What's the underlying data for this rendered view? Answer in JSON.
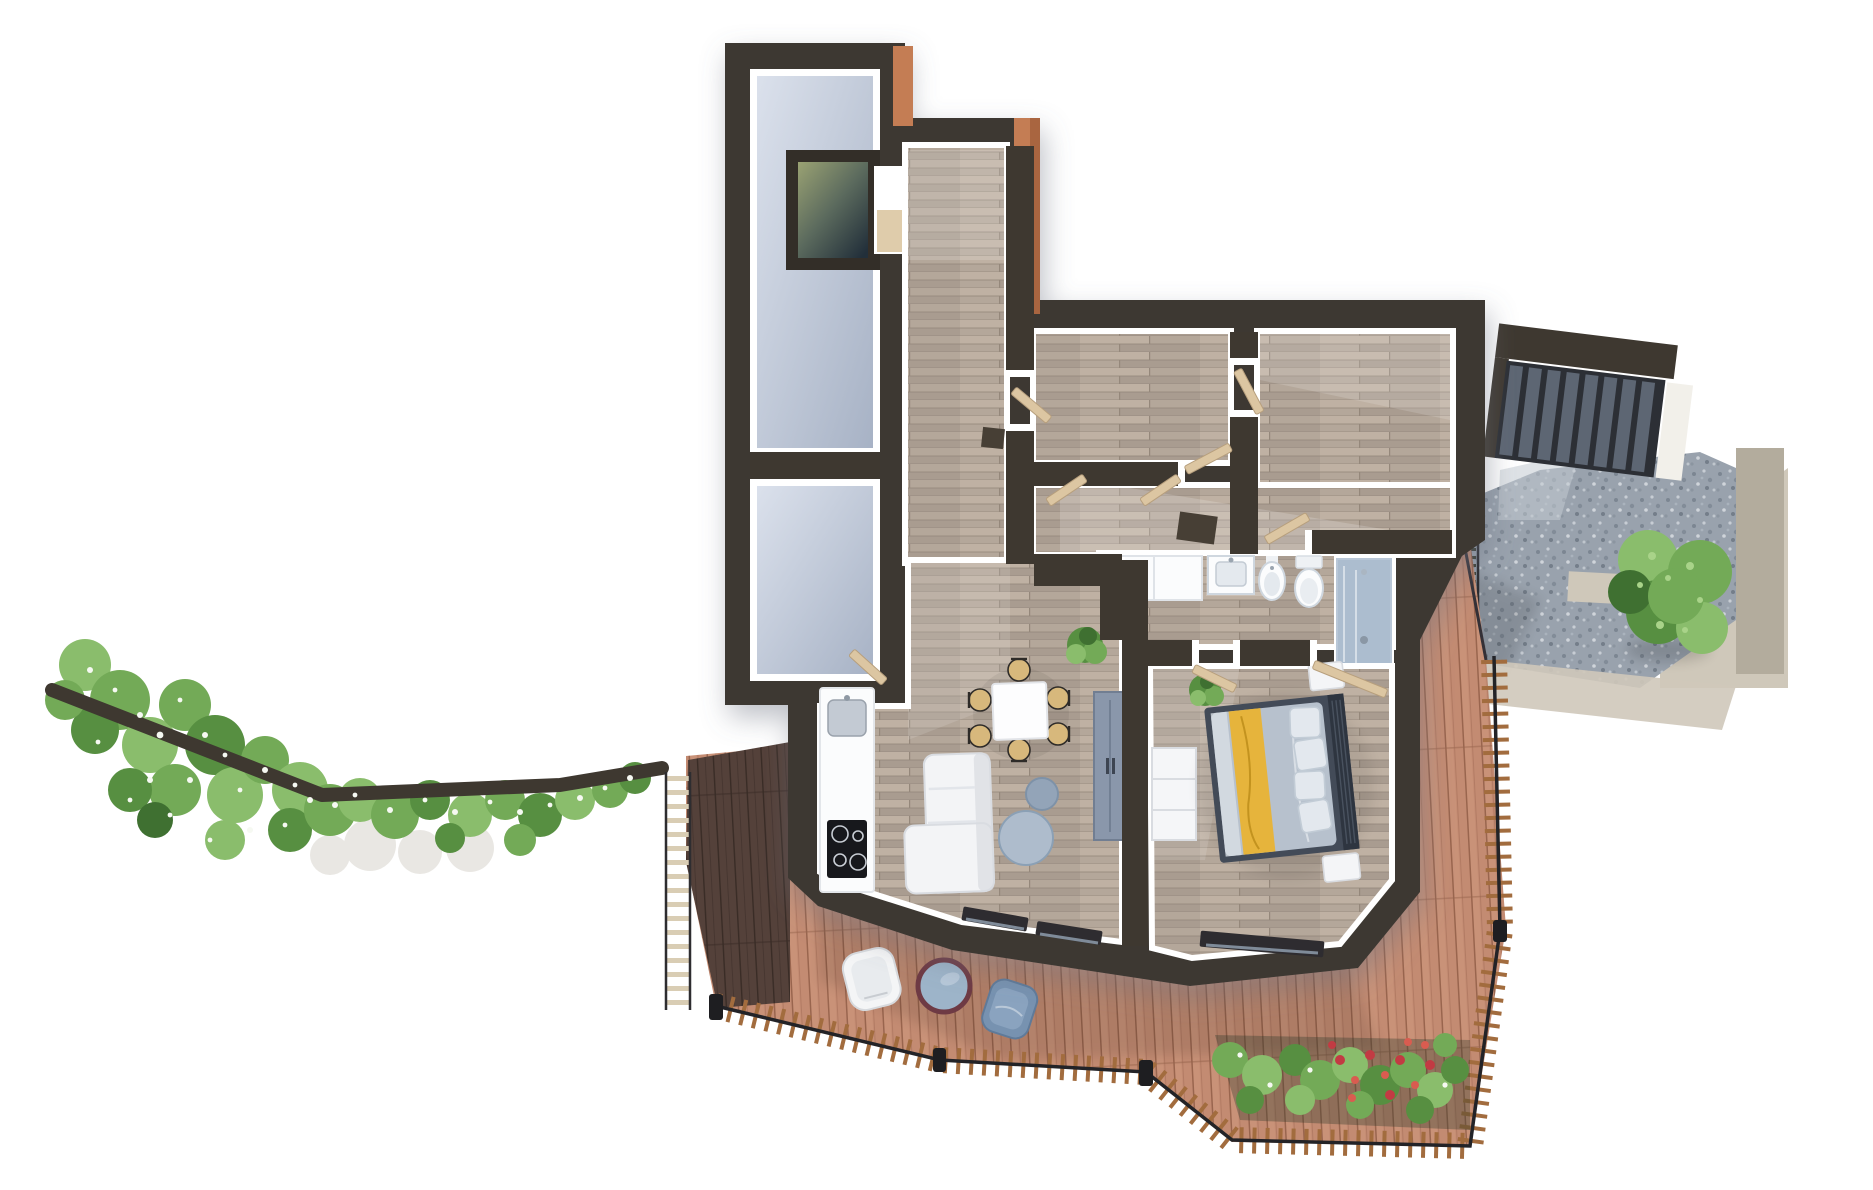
{
  "meta": {
    "type": "3d-floorplan-render",
    "view": "top-down-isometric",
    "text_visible": false
  },
  "colors": {
    "wall": "#3e3830",
    "wallEdge": "#2c2721",
    "copper": "#c47d54",
    "copperD": "#a96540",
    "conc1": "#dbe1ec",
    "conc2": "#a7b2c5",
    "wood": "#b4a79a",
    "woodGap": "#95887b",
    "woodL": "#c9bcac",
    "woodD": "#a29588",
    "deck": "#c38b72",
    "deckGap": "#99654e",
    "deckL": "#d8a489",
    "deckD": "#54413a",
    "deckDGap": "#392c26",
    "railWood": "#a26c3e",
    "rail": "#232327",
    "slat": "#d9cdb4",
    "gravel": "#99a2ad",
    "stone": "#cfc8ba",
    "stoneD": "#b3ac9d",
    "stair": "#5d6673",
    "stairD": "#2c2f35",
    "door": "#dcc6a2",
    "doorEdge": "#b79f7d",
    "white": "#ffffff",
    "offwhite": "#eef0f3",
    "sofa": "#f3f4f6",
    "sofaD": "#d9dce1",
    "tblBlue": "#aebccc",
    "tblBlue2": "#93a4b8",
    "chairTan": "#d7b87c",
    "chairFrame": "#2e2b28",
    "cooktop": "#17181c",
    "steel": "#c3cad3",
    "shower": "#8aa2bd",
    "fixture": "#fbfcfd",
    "fixEdge": "#cfd7df",
    "basin": "#e4e9ee",
    "wardrobe": "#8a97ab",
    "glass": "#9db4c9",
    "tableRim": "#6e3a44",
    "blueChair": "#7792b0",
    "blueChairL": "#8aa3bf",
    "bedFrame": "#434b58",
    "bedHead": "#2e3540",
    "duvet": "#b7c1cd",
    "duvetL": "#d8dee5",
    "yellow": "#e6b43c",
    "yellowD": "#c3931f",
    "pillow": "#e3e8ee",
    "g0": "#3f7031",
    "g1": "#73aa57",
    "g2": "#8abd6c",
    "g3": "#578f41",
    "g4": "#a9d389",
    "r1": "#c23b43",
    "r2": "#d95c50",
    "fw": "#f6f9f2",
    "path": "#e7e5e0",
    "soil": "#2f3a2c"
  },
  "scene": {
    "rooms": [
      "stairwell-with-skylight",
      "storage-room",
      "corridor",
      "room-a",
      "room-b",
      "hallway",
      "bathroom",
      "shower-room",
      "living-dining-kitchen",
      "bedroom"
    ],
    "furniture": [
      "kitchen-counter",
      "sink",
      "cooktop",
      "dining-table",
      "dining-chairs",
      "sofa",
      "coffee-tables",
      "wardrobe",
      "dresser",
      "vanity",
      "washbasin",
      "bidet",
      "toilet",
      "shower",
      "double-bed",
      "nightstands",
      "plants"
    ],
    "exterior": [
      "terrace-deck",
      "deck-railing",
      "pergola-slats",
      "outdoor-chair-white",
      "outdoor-table-round",
      "outdoor-chair-blue",
      "flower-bed",
      "hedge-with-flowers",
      "gravel-courtyard",
      "retaining-walls",
      "exterior-stairs",
      "tree"
    ]
  },
  "scatter": {
    "hedge": [
      [
        85,
        665,
        26,
        "g2"
      ],
      [
        120,
        700,
        30,
        "g1"
      ],
      [
        95,
        730,
        24,
        "g3"
      ],
      [
        150,
        745,
        28,
        "g2"
      ],
      [
        185,
        705,
        26,
        "g1"
      ],
      [
        215,
        745,
        30,
        "g3"
      ],
      [
        175,
        790,
        26,
        "g1"
      ],
      [
        235,
        795,
        28,
        "g2"
      ],
      [
        130,
        790,
        22,
        "g3"
      ],
      [
        265,
        760,
        24,
        "g1"
      ],
      [
        300,
        790,
        28,
        "g2"
      ],
      [
        290,
        830,
        22,
        "g3"
      ],
      [
        330,
        810,
        26,
        "g1"
      ],
      [
        225,
        840,
        20,
        "g2"
      ],
      [
        360,
        800,
        22,
        "g2"
      ],
      [
        395,
        815,
        24,
        "g1"
      ],
      [
        430,
        800,
        20,
        "g3"
      ],
      [
        470,
        815,
        22,
        "g2"
      ],
      [
        505,
        800,
        20,
        "g1"
      ],
      [
        540,
        815,
        22,
        "g3"
      ],
      [
        575,
        800,
        20,
        "g2"
      ],
      [
        610,
        790,
        18,
        "g1"
      ],
      [
        635,
        778,
        16,
        "g3"
      ],
      [
        65,
        700,
        20,
        "g1"
      ],
      [
        155,
        820,
        18,
        "g0"
      ],
      [
        520,
        840,
        16,
        "g1"
      ],
      [
        450,
        838,
        15,
        "g3"
      ]
    ],
    "hedgeFlowers": [
      [
        90,
        670,
        3,
        "fw"
      ],
      [
        115,
        690,
        2.4,
        "fw"
      ],
      [
        140,
        715,
        3,
        "fw"
      ],
      [
        98,
        742,
        2.4,
        "fw"
      ],
      [
        160,
        735,
        3.4,
        "fw"
      ],
      [
        180,
        700,
        2.4,
        "fw"
      ],
      [
        205,
        735,
        3,
        "fw"
      ],
      [
        225,
        755,
        2.4,
        "fw"
      ],
      [
        190,
        780,
        3,
        "fw"
      ],
      [
        240,
        790,
        2.4,
        "fw"
      ],
      [
        150,
        780,
        3,
        "fw"
      ],
      [
        130,
        800,
        2.4,
        "fw"
      ],
      [
        265,
        770,
        3,
        "fw"
      ],
      [
        295,
        785,
        2.4,
        "fw"
      ],
      [
        310,
        800,
        3,
        "fw"
      ],
      [
        285,
        825,
        2.4,
        "fw"
      ],
      [
        335,
        805,
        3,
        "fw"
      ],
      [
        355,
        795,
        2.4,
        "fw"
      ],
      [
        390,
        810,
        3,
        "fw"
      ],
      [
        425,
        800,
        2.4,
        "fw"
      ],
      [
        455,
        812,
        3,
        "fw"
      ],
      [
        490,
        802,
        2.4,
        "fw"
      ],
      [
        520,
        812,
        3,
        "fw"
      ],
      [
        550,
        805,
        2.4,
        "fw"
      ],
      [
        580,
        798,
        3,
        "fw"
      ],
      [
        605,
        788,
        2.4,
        "fw"
      ],
      [
        630,
        778,
        3,
        "fw"
      ],
      [
        210,
        840,
        2.4,
        "fw"
      ],
      [
        250,
        830,
        3,
        "fw"
      ],
      [
        170,
        815,
        2.4,
        "fw"
      ]
    ],
    "pathBlobs": [
      [
        370,
        845,
        26,
        "path"
      ],
      [
        420,
        852,
        22,
        "path"
      ],
      [
        470,
        848,
        24,
        "path"
      ],
      [
        330,
        855,
        20,
        "path"
      ]
    ],
    "flowerbedGreens": [
      [
        1230,
        1060,
        18,
        "g1"
      ],
      [
        1262,
        1075,
        20,
        "g2"
      ],
      [
        1295,
        1060,
        16,
        "g3"
      ],
      [
        1320,
        1080,
        20,
        "g1"
      ],
      [
        1350,
        1065,
        18,
        "g2"
      ],
      [
        1380,
        1085,
        20,
        "g3"
      ],
      [
        1408,
        1070,
        18,
        "g1"
      ],
      [
        1435,
        1090,
        18,
        "g2"
      ],
      [
        1455,
        1070,
        14,
        "g3"
      ],
      [
        1250,
        1100,
        14,
        "g3"
      ],
      [
        1300,
        1100,
        15,
        "g2"
      ],
      [
        1360,
        1105,
        14,
        "g1"
      ],
      [
        1420,
        1110,
        14,
        "g3"
      ],
      [
        1445,
        1045,
        12,
        "g1"
      ]
    ],
    "flowerbedRed": [
      [
        1340,
        1060,
        5,
        "r1"
      ],
      [
        1355,
        1080,
        4,
        "r2"
      ],
      [
        1370,
        1055,
        5,
        "r1"
      ],
      [
        1385,
        1075,
        4,
        "r2"
      ],
      [
        1400,
        1060,
        5,
        "r1"
      ],
      [
        1415,
        1085,
        4,
        "r2"
      ],
      [
        1430,
        1065,
        5,
        "r1"
      ],
      [
        1352,
        1098,
        4,
        "r2"
      ],
      [
        1390,
        1095,
        5,
        "r1"
      ],
      [
        1425,
        1045,
        4,
        "r2"
      ],
      [
        1332,
        1045,
        4,
        "r1"
      ],
      [
        1408,
        1042,
        4,
        "r2"
      ]
    ],
    "flowerbedWhite": [
      [
        1240,
        1055,
        2.6,
        "fw"
      ],
      [
        1270,
        1085,
        2.6,
        "fw"
      ],
      [
        1310,
        1070,
        2.6,
        "fw"
      ],
      [
        1445,
        1085,
        2.6,
        "fw"
      ]
    ],
    "treeBlobs": [
      [
        1648,
        560,
        30,
        "g2"
      ],
      [
        1700,
        572,
        32,
        "g1"
      ],
      [
        1658,
        612,
        32,
        "g3"
      ],
      [
        1702,
        628,
        26,
        "g2"
      ],
      [
        1630,
        592,
        22,
        "g0"
      ],
      [
        1676,
        596,
        28,
        "g1"
      ]
    ],
    "treeHi": [
      [
        1652,
        556,
        4,
        "g4"
      ],
      [
        1668,
        578,
        3,
        "g4"
      ],
      [
        1690,
        566,
        4,
        "g4"
      ],
      [
        1700,
        600,
        3,
        "g4"
      ],
      [
        1660,
        625,
        4,
        "g4"
      ],
      [
        1640,
        585,
        3,
        "g4"
      ],
      [
        1685,
        630,
        3,
        "g4"
      ]
    ]
  }
}
